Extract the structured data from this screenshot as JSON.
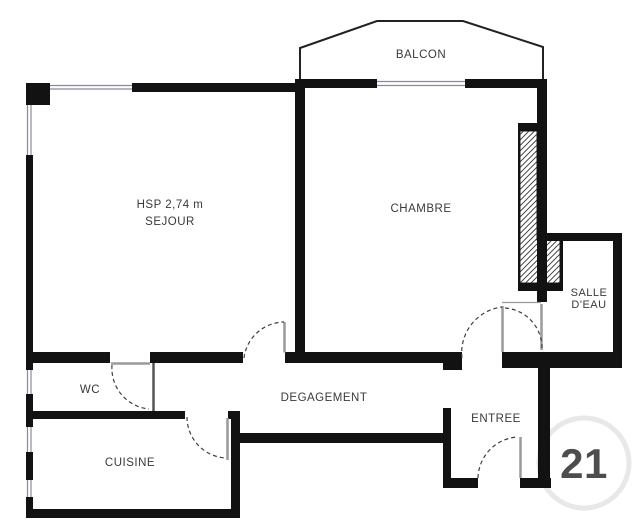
{
  "colors": {
    "wall": "#121212",
    "balcony_outline": "#222222",
    "window_line": "#8b8b97",
    "door_leaf": "#9a9a9a",
    "partition_line": "#555555",
    "arc": "#3f3f3f",
    "hatch_line": "#333333",
    "text": "#3a3a3a",
    "watermark": "#e4e4e4"
  },
  "plan": {
    "balcon": {
      "label": "BALCON"
    },
    "sejour": {
      "hsp_label": "HSP 2,74 m",
      "label": "SEJOUR"
    },
    "chambre": {
      "label": "CHAMBRE"
    },
    "salle_deau": {
      "line1": "SALLE",
      "line2": "D'EAU"
    },
    "wc": {
      "label": "WC"
    },
    "degagement": {
      "label": "DEGAGEMENT"
    },
    "entree": {
      "label": "ENTREE"
    },
    "cuisine": {
      "label": "CUISINE"
    },
    "watermark": {
      "label": "21"
    }
  }
}
